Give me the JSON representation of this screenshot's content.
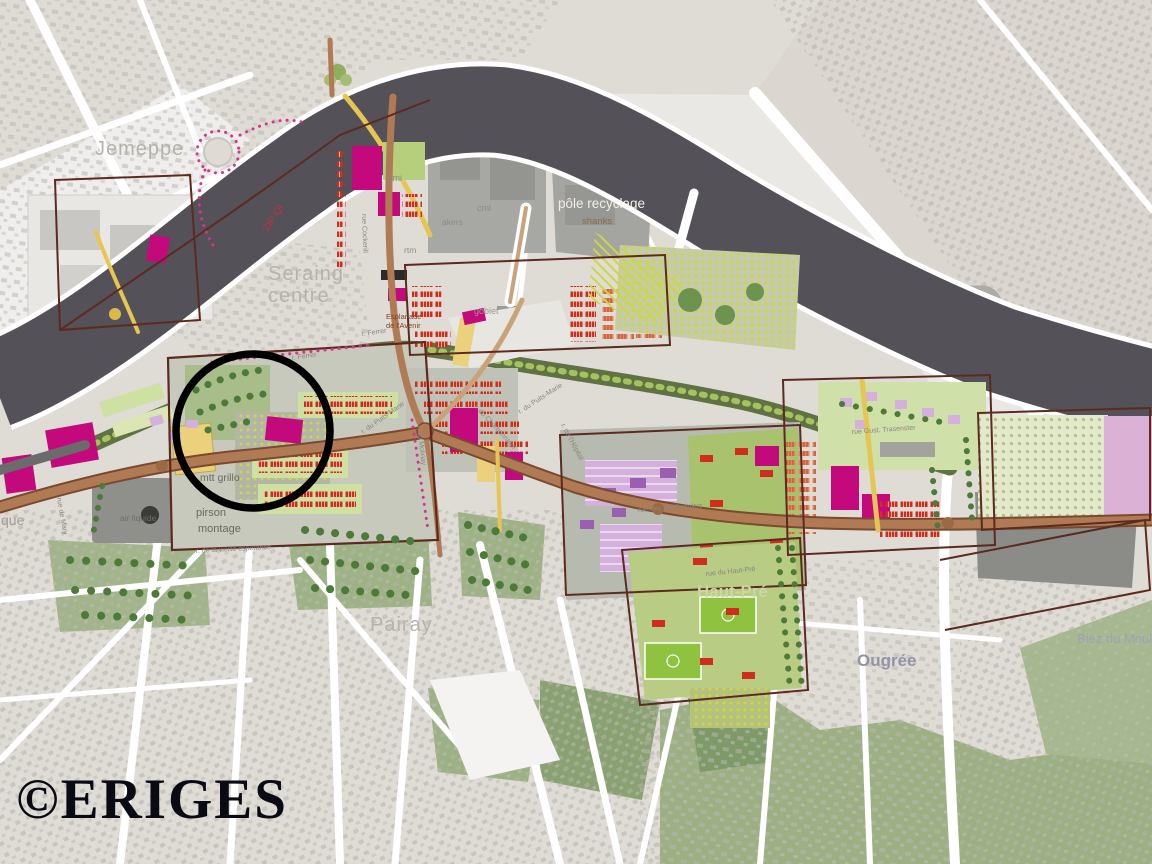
{
  "map": {
    "kind": "urban masterplan map (Seraing, river Meuse)",
    "watermark": {
      "text": "©ERIGES"
    },
    "annotation": {
      "shape": "circle",
      "purpose": "hand-drawn emphasis ring",
      "cx": 253,
      "cy": 431,
      "r": 77,
      "color": "#000000"
    },
    "colors": {
      "background": "#dfdcd6",
      "river": "#545158",
      "boulevard": "#b07a55",
      "boundary_brown": "#5d2a20",
      "magenta": "#c4097c",
      "red_housing": "#cf2d1e",
      "orange": "#e2875f",
      "light_green": "#cfe1a2",
      "park_green": "#9db285",
      "tree_green": "#4d7a38",
      "lilac": "#d6b0dc",
      "yellow": "#ecd17c",
      "dotted_magenta": "#d6338a",
      "watermark_black": "#0a0a12"
    },
    "districts": {
      "jemeppe": "Jemeppe",
      "seraing_line1": "Seraing",
      "seraing_line2": "centre",
      "pairay": "Pairay",
      "haut_pre": "Haut-Pré",
      "ougree": "Ougrée",
      "biez_du_moulin": "Biez du Moulin"
    },
    "sites": {
      "pole_recyclage": "pôle recyclage",
      "shanks": "shanks",
      "cmi_a": "cmi",
      "cmi_b": "cmi",
      "akers": "akers",
      "rtm": "rtm",
      "gobiet": "gobiet",
      "air_liquide": "air liquide",
      "mtt_grillo": "mtt grillo",
      "pirson_line1": "pirson",
      "pirson_line2": "montage",
      "esplanade_line1": "Esplanade",
      "esplanade_line2": "de l'Avenir",
      "zip_qi": "ZIP-QI",
      "edge_partial": "que"
    },
    "streets": {
      "cockerill": "rue Cockerill",
      "puits_marie_w": "r. du Puits-Marie",
      "puits_marie_n": "r. du Puits-Marie",
      "charbonnage": "r. du Charbonnage",
      "molinay": "r. du Molinay",
      "hopital": "r. de l'Hôpital",
      "ferrer_a": "r. Ferrer",
      "ferrer_b": "r. Ferrer",
      "six_bonniers": "rue des Six-Bonniers",
      "haut_pre_rue": "rue du Haut-Pré",
      "trasenster": "rue Gust. Trasenster",
      "mary": "rue de Mary",
      "esperance": "r. de la vieille espérance"
    }
  }
}
